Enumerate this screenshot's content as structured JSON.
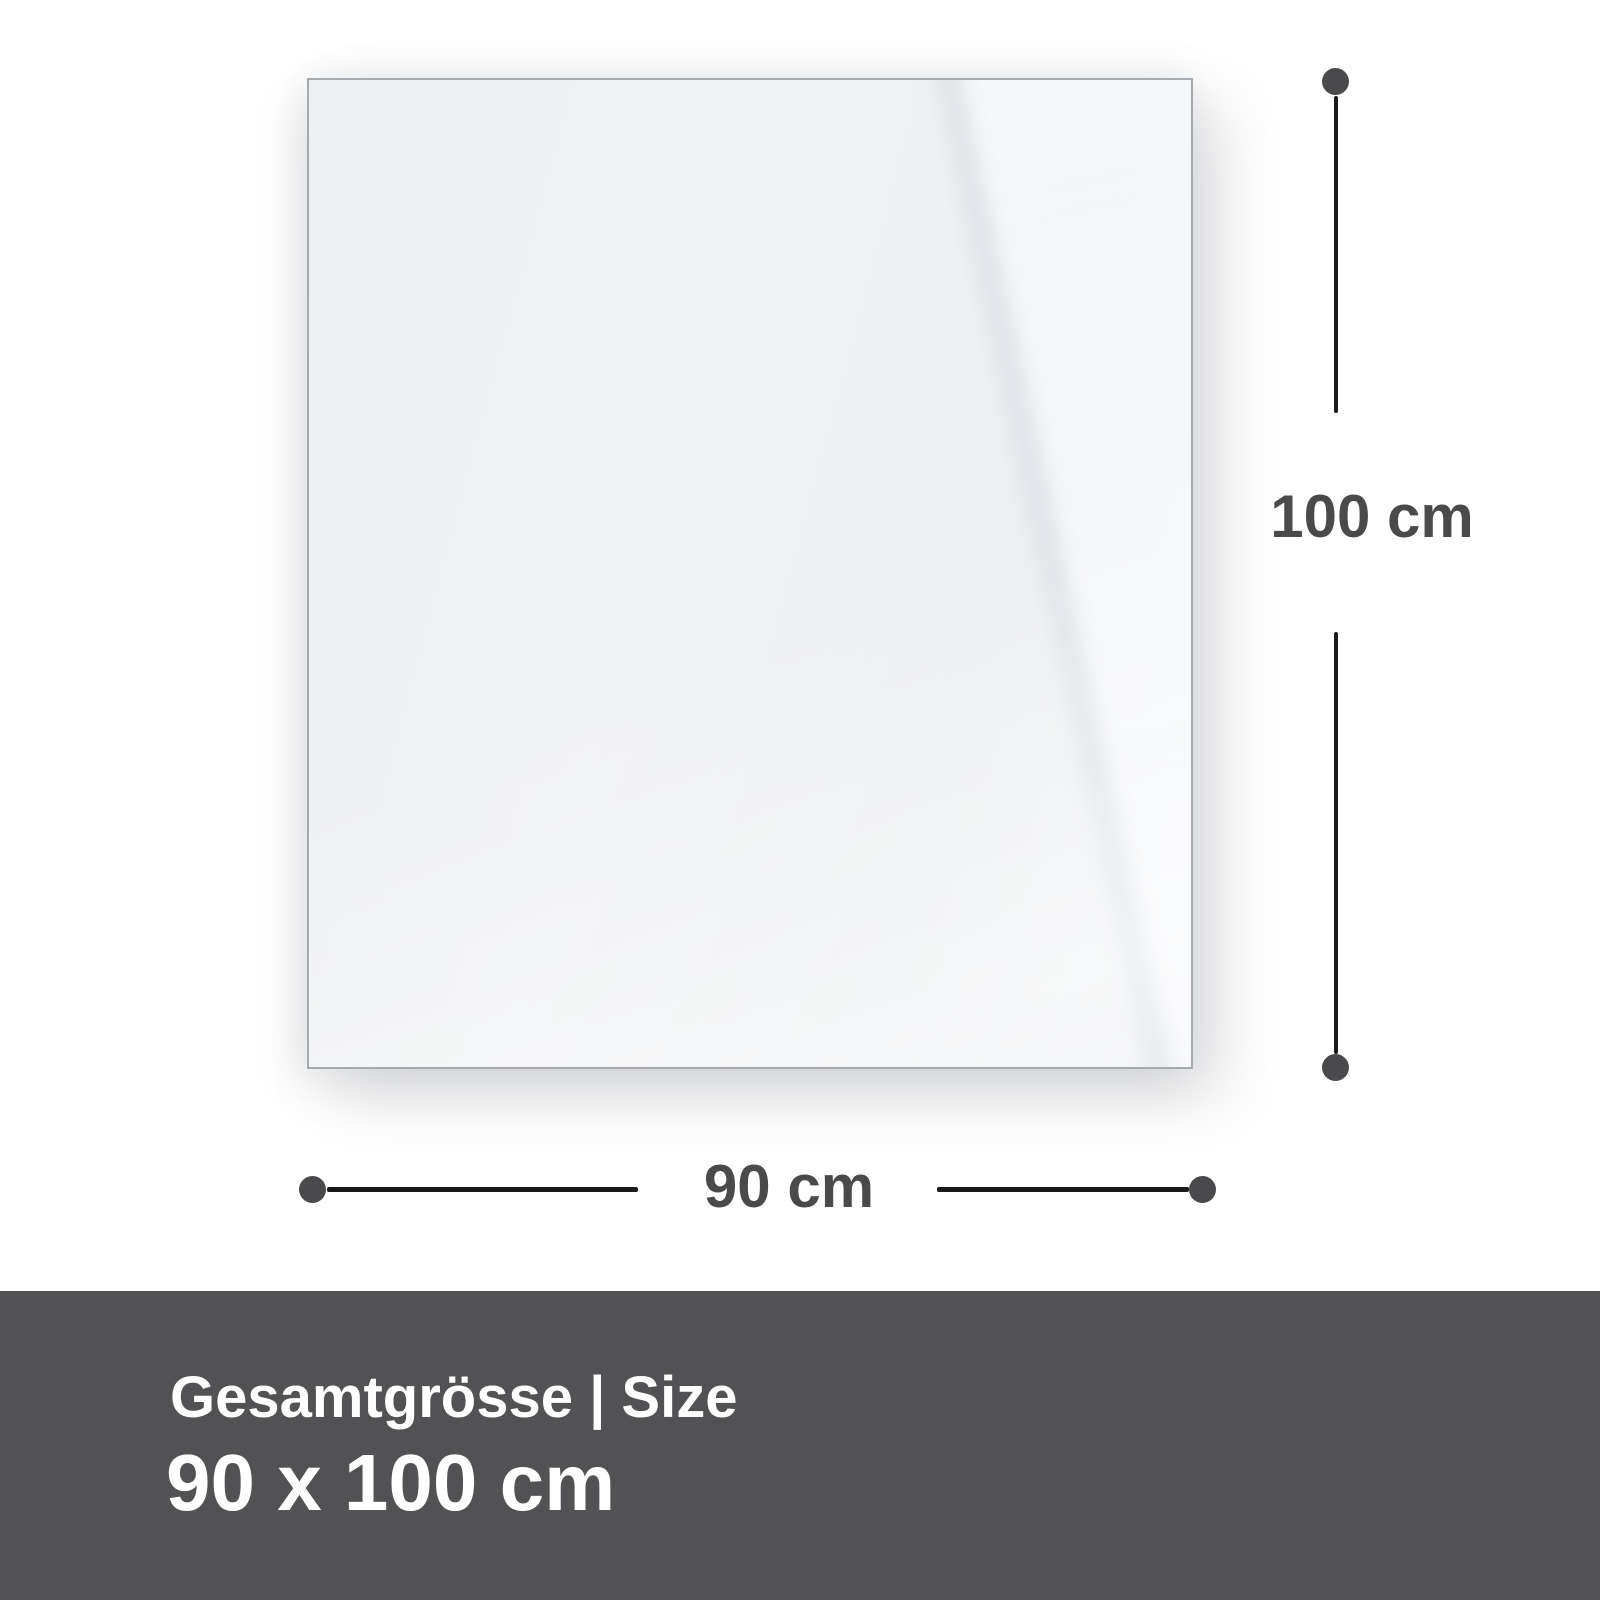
{
  "diagram": {
    "description_labels": {
      "height_label": "100 cm",
      "width_label": "90 cm"
    }
  },
  "footer": {
    "title": "Gesamtgrösse | Size",
    "size_value": "90 x 100 cm"
  },
  "colors": {
    "bg": "#ffffff",
    "panel-border": "#a7aaae",
    "panel-base": "#eff0f2",
    "line-color": "#1a1a1a",
    "dot-color": "#4a4a4c",
    "label-color": "#4a4a4a",
    "footer-bg": "#525254",
    "footer-text": "#ffffff"
  }
}
